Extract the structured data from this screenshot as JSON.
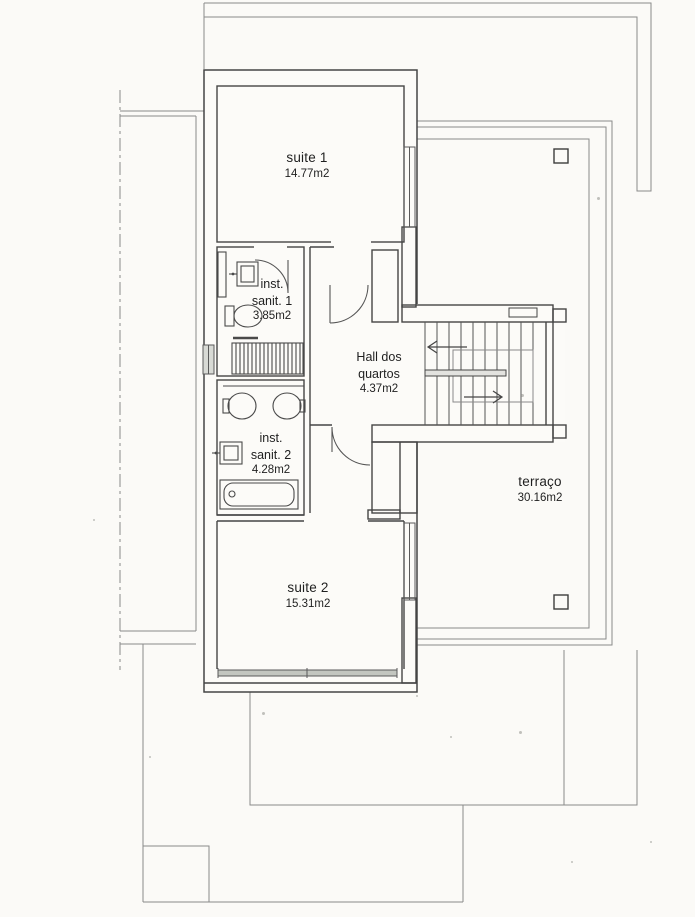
{
  "rooms": {
    "suite1": {
      "name": "suite 1",
      "area": "14.77m2"
    },
    "sanit1": {
      "line1": "inst.",
      "line2": "sanit. 1",
      "area": "3.85m2"
    },
    "hall": {
      "line1": "Hall dos",
      "line2": "quartos",
      "area": "4.37m2"
    },
    "sanit2": {
      "line1": "inst.",
      "line2": "sanit. 2",
      "area": "4.28m2"
    },
    "suite2": {
      "name": "suite 2",
      "area": "15.31m2"
    },
    "terraco": {
      "name": "terraço",
      "area": "30.16m2"
    }
  },
  "colors": {
    "paper": "#fbfaf7",
    "wall_line": "#454545",
    "thin_outline": "#8a8a8a",
    "glazing_fill": "#c3c6c0"
  }
}
